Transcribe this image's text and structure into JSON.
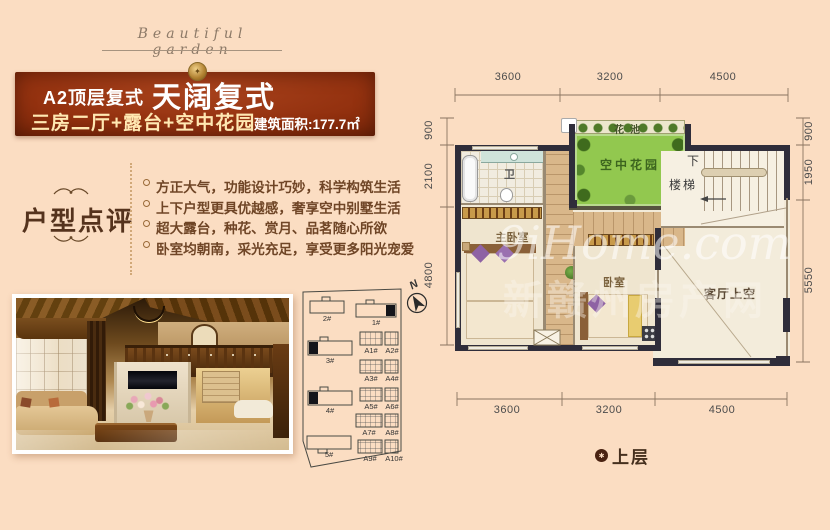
{
  "brand": {
    "script_title": "Beautiful garden"
  },
  "banner": {
    "tag": "A2顶层复式",
    "title": "天阔复式",
    "subtitle": "三房二厅+露台+空中花园",
    "area": "建筑面积:177.7㎡"
  },
  "review": {
    "heading": "户型点评",
    "bullets": [
      "方正大气，功能设计巧妙，科学构筑生活",
      "上下户型更具优越感，奢享空中别墅生活",
      "超大露台，种花、赏月、品茗随心所欲",
      "卧室均朝南，采光充足，享受更多阳光宠爱"
    ]
  },
  "site_plan": {
    "compass": "N",
    "buildings": [
      "2#",
      "1#",
      "3#",
      "4#",
      "5#"
    ],
    "blocks": [
      "A1#",
      "A2#",
      "A3#",
      "A4#",
      "A5#",
      "A6#",
      "A7#",
      "A8#",
      "A9#",
      "A10#"
    ]
  },
  "floor_plan": {
    "rooms": {
      "flower_bed": "花池",
      "sky_garden": "空中花园",
      "bath": "卫",
      "master_bedroom": "主卧室",
      "bedroom": "卧室",
      "down": "下",
      "stairs": "楼梯",
      "living_void": "客厅上空"
    },
    "dims_top": [
      "3600",
      "3200",
      "4500"
    ],
    "dims_bottom": [
      "3600",
      "3200",
      "4500"
    ],
    "dims_left": [
      "900",
      "2100",
      "4800"
    ],
    "dims_right": [
      "900",
      "1950",
      "5550"
    ],
    "floor_label": "上层"
  },
  "watermark": {
    "latin": "9iHome.com",
    "cn": "新赣州房产网"
  },
  "colors": {
    "banner_red": "#93310f",
    "accent_gold": "#ffe8b2",
    "garden_green": "#92c84f",
    "wall_dark": "#2f2d3a"
  }
}
